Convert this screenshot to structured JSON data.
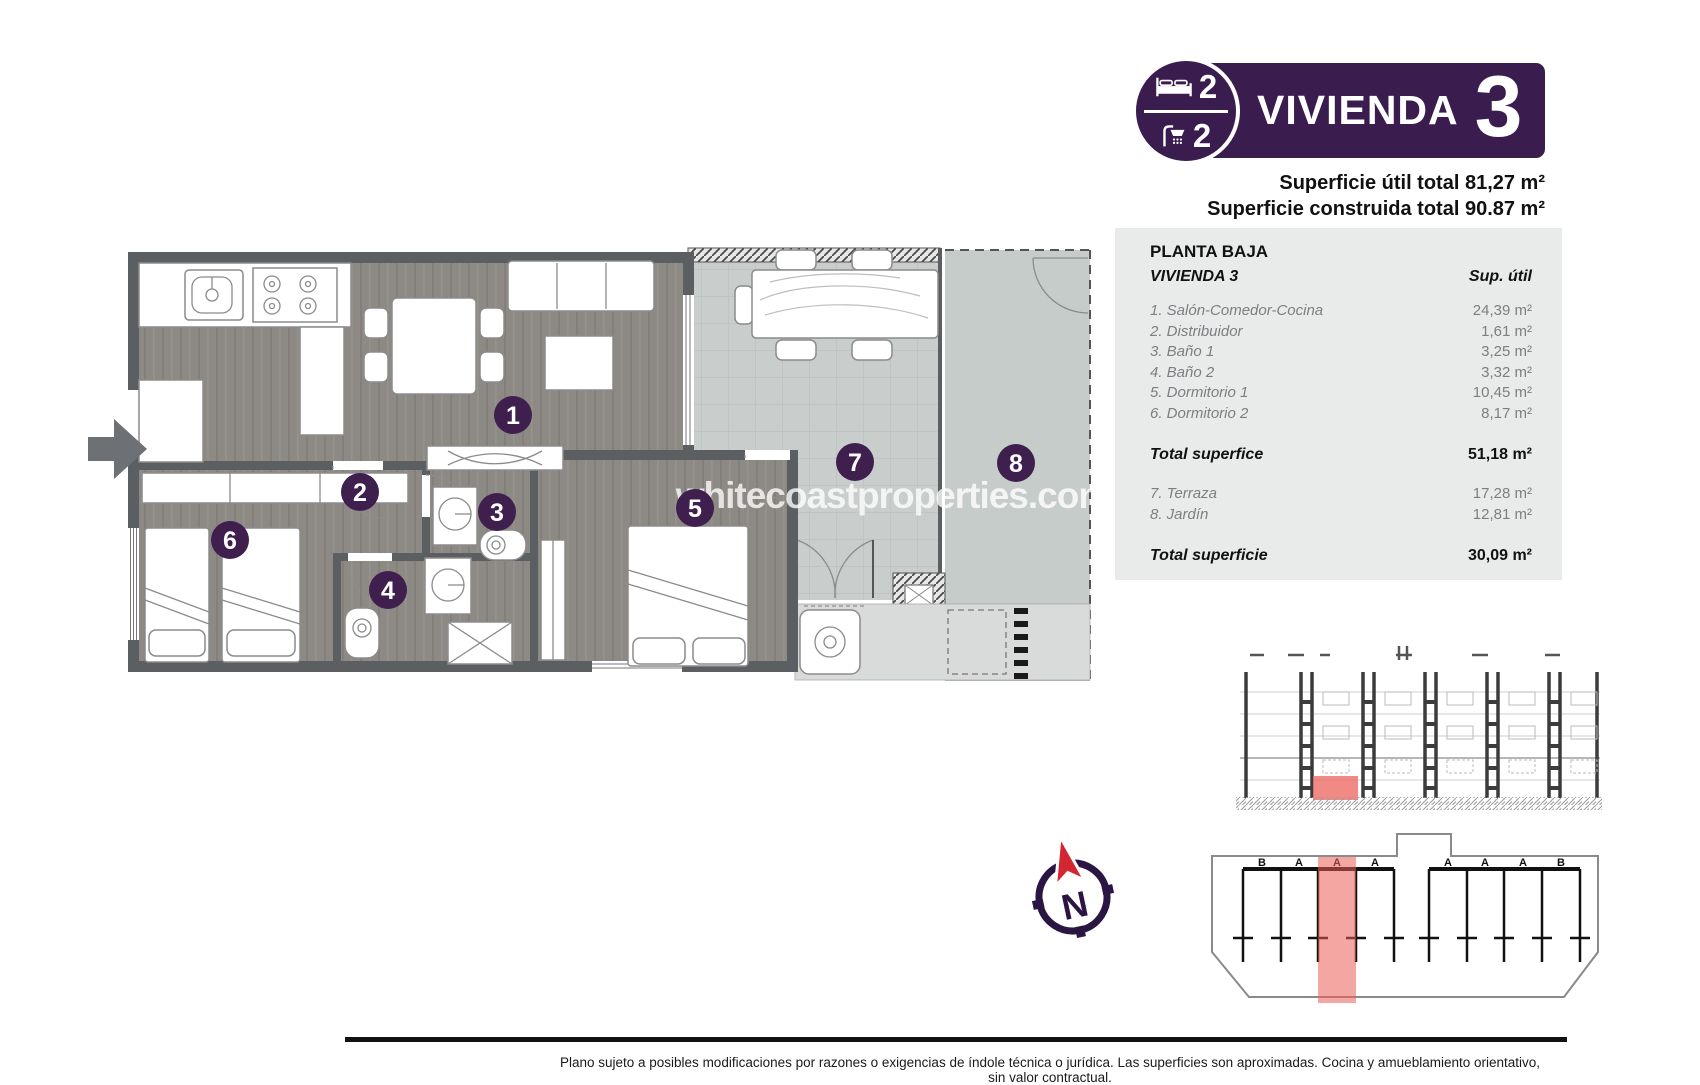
{
  "badge": {
    "title": "VIVIENDA",
    "number": "3",
    "bedrooms": "2",
    "bathrooms": "2"
  },
  "header": {
    "line1": "Superficie útil total 81,27 m²",
    "line2": "Superficie construida total 90.87 m²"
  },
  "table": {
    "title": "PLANTA BAJA",
    "subtitle": "VIVIENDA 3",
    "col_header": "Sup. útil",
    "rows": [
      {
        "label": "1. Salón-Comedor-Cocina",
        "value": "24,39 m²"
      },
      {
        "label": "2. Distribuidor",
        "value": "1,61 m²"
      },
      {
        "label": "3. Baño 1",
        "value": "3,25 m²"
      },
      {
        "label": "4. Baño 2",
        "value": "3,32 m²"
      },
      {
        "label": "5. Dormitorio 1",
        "value": "10,45 m²"
      },
      {
        "label": "6. Dormitorio 2",
        "value": "8,17 m²"
      }
    ],
    "total1_label": "Total superfice",
    "total1_value": "51,18 m²",
    "outdoor_rows": [
      {
        "label": "7. Terraza",
        "value": "17,28 m²"
      },
      {
        "label": "8. Jardín",
        "value": "12,81 m²"
      }
    ],
    "total2_label": "Total superficie",
    "total2_value": "30,09 m²"
  },
  "plan": {
    "watermark": "whitecoastproperties.com",
    "room_numbers": [
      "1",
      "2",
      "3",
      "4",
      "5",
      "6",
      "7",
      "8"
    ]
  },
  "compass": {
    "north_label": "N"
  },
  "site_plan": {
    "unit_labels": [
      "B",
      "A",
      "A",
      "A",
      "A",
      "A",
      "A",
      "B"
    ]
  },
  "footer": {
    "disclaimer": "Plano sujeto a posibles modificaciones por razones o exigencias de índole técnica o jurídica. Las superficies son aproximadas. Cocina y amueblamiento orientativo, sin valor contractual."
  },
  "colors": {
    "brand_purple": "#3a1d4e",
    "compass_red": "#d22630",
    "highlight_red": "#ee6b66",
    "panel_gray": "#e9ebea",
    "wall_gray": "#5c5f62",
    "floor_wood": "#8d8984",
    "terrace_tile": "#c9cdcc",
    "garden_gray": "#c6ccca"
  }
}
